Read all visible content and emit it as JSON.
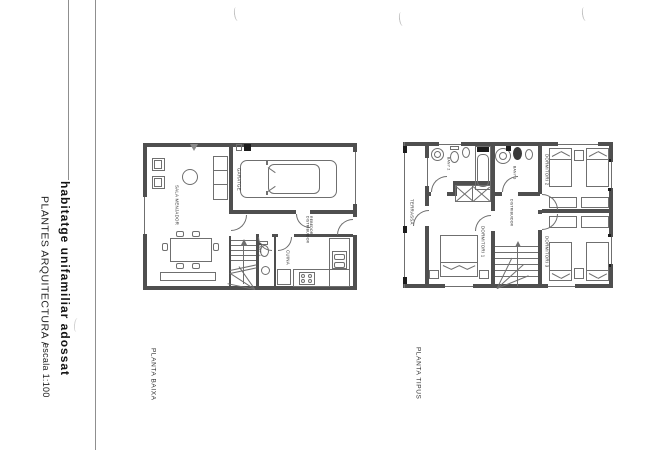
{
  "colors": {
    "paper": "#ffffff",
    "ink": "#2b2b2b",
    "wall": "#4f4f4f",
    "line": "#6f6f6f"
  },
  "title_block": {
    "project_title": "habitatge unifamiliar adossat",
    "sheet_name": "PLANTES ARQUITECTURA /",
    "scale": "escala 1:100"
  },
  "ground_floor": {
    "caption": "PLANTA BAIXA",
    "rooms": {
      "sala": "SALA MENJADOR",
      "garatge": "GARATGE",
      "rebedor": "REBEDOR",
      "distribuidor": "DISTRIBUIDOR",
      "bany1": "BANY 1",
      "cuina": "CUINA"
    }
  },
  "upper_floor": {
    "caption": "PLANTA TIPUS",
    "rooms": {
      "terrassa": "TERRASSA",
      "bany2": "BANY 2",
      "bany3": "BANY 3",
      "distribuidor": "DISTRIBUIDOR",
      "dorm1": "DORMITORI 1",
      "dorm2": "DORMITORI 2",
      "dorm3": "DORMITORI 3"
    }
  }
}
